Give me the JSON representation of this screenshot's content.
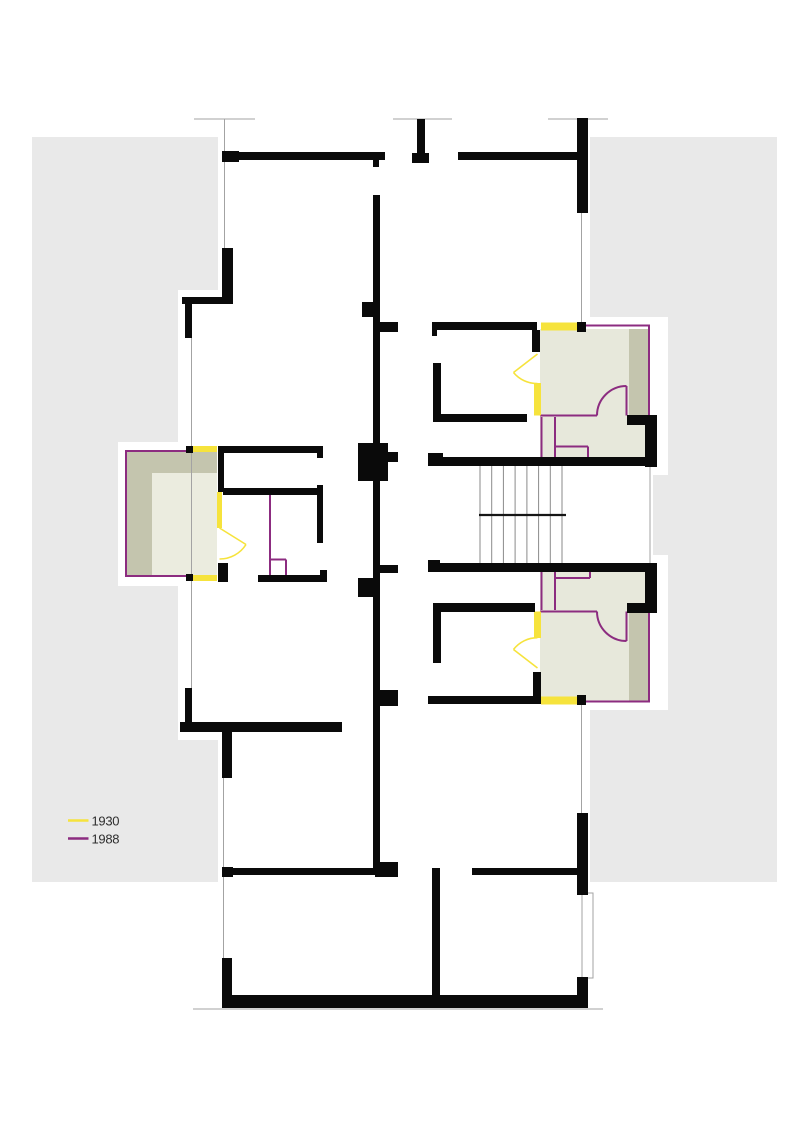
{
  "legend": {
    "items": [
      {
        "label": "1930",
        "color": "#f6e33c"
      },
      {
        "label": "1988",
        "color": "#8c2c80"
      }
    ]
  },
  "palette": {
    "paper": "#ffffff",
    "band": "#e9e9e9",
    "wall": "#0a0a0a",
    "shade_light": "#e7e8db",
    "shade_olive": "#c4c5ae",
    "balcony_light": "#ebecdf",
    "thin_line": "#a3a3a3",
    "tread": "#8a8a8a",
    "landing": "#151515",
    "text": "#2e2e2e",
    "c1930": "#f6e33c",
    "c1988": "#8c2c80"
  }
}
